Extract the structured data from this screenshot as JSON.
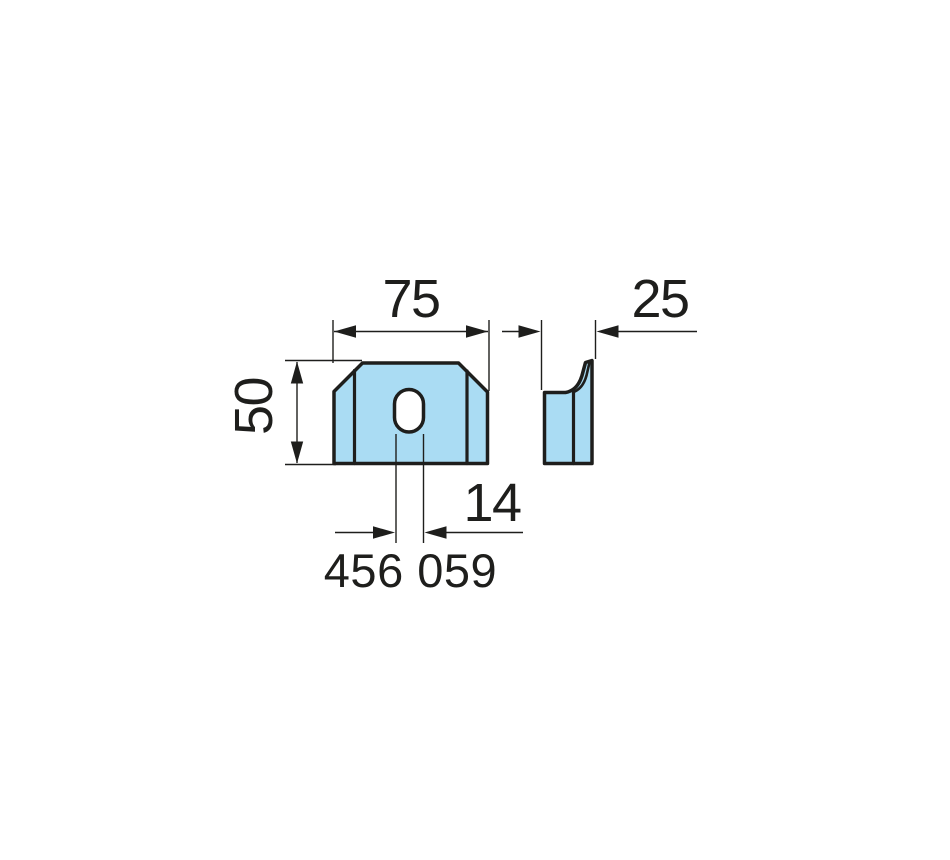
{
  "part": {
    "number": "456 059"
  },
  "dimensions": {
    "width_mm": "75",
    "depth_mm": "25",
    "height_mm": "50",
    "slot_width_mm": "14"
  },
  "colors": {
    "fill": "#aadcf3",
    "outline": "#1e1e1c",
    "hole_fill": "#ffffff",
    "background": "#ffffff"
  }
}
